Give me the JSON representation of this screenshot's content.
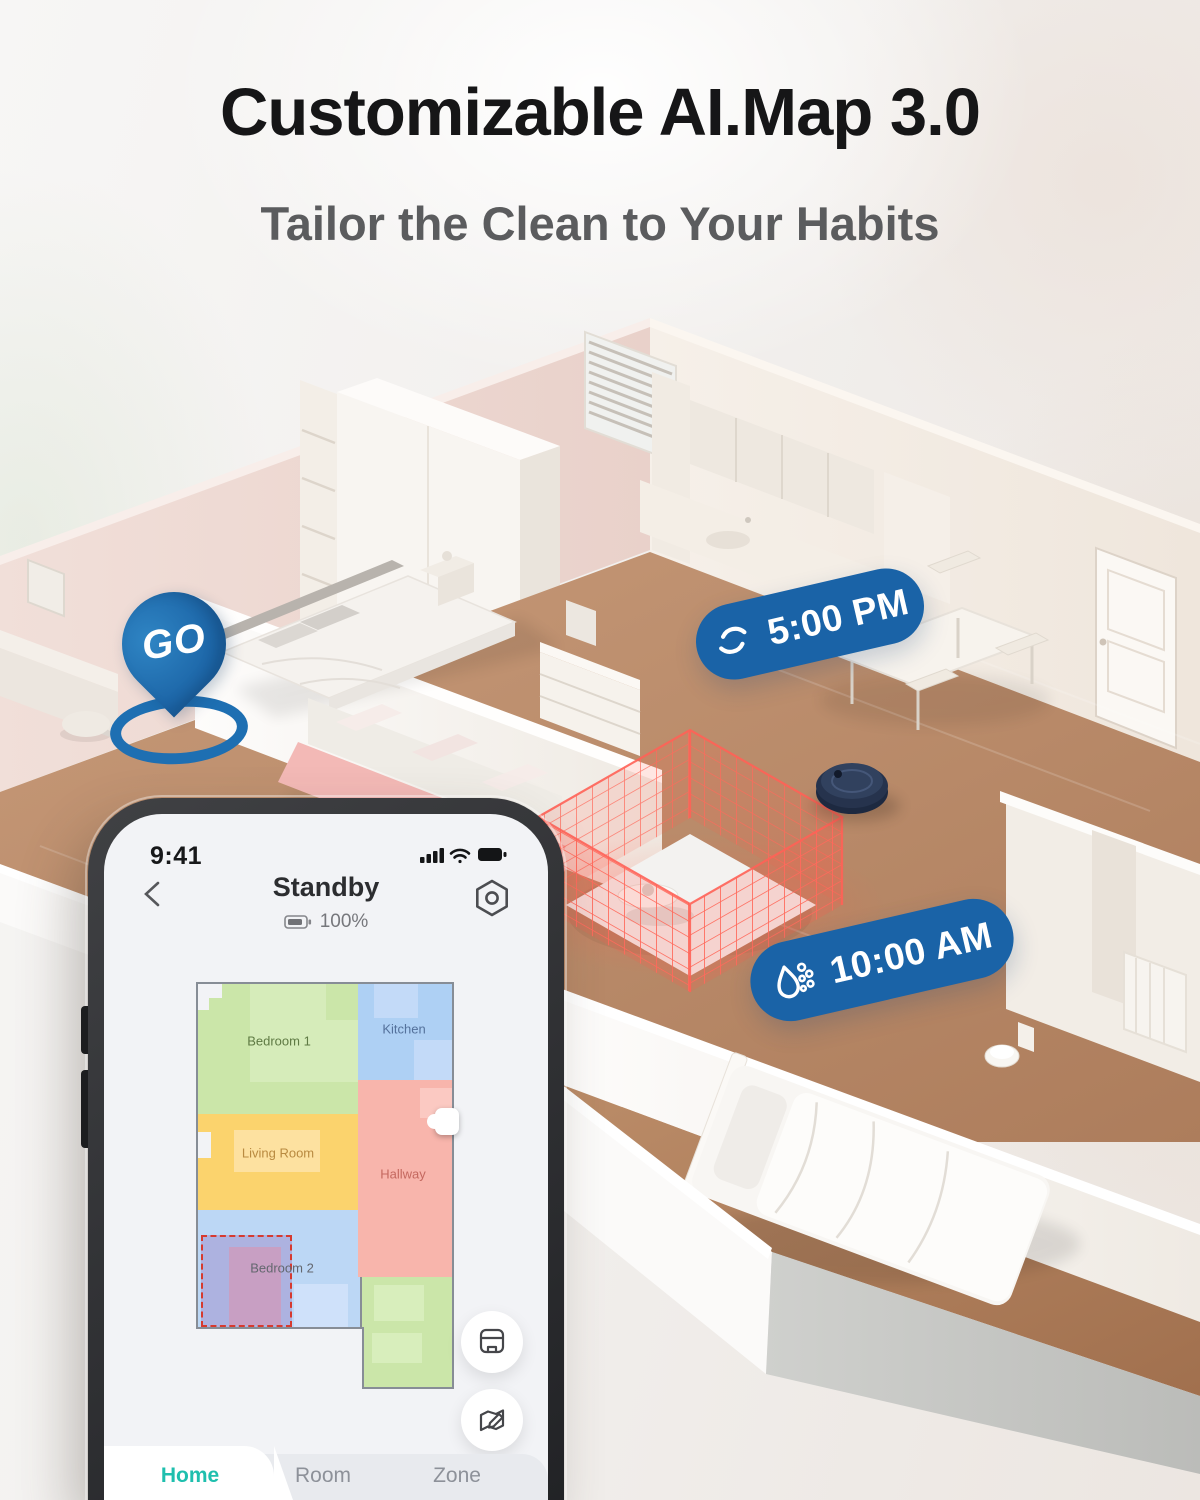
{
  "title": "Customizable AI.Map 3.0",
  "subtitle": "Tailor the Clean to Your Habits",
  "scene": {
    "go_pin": {
      "label": "GO",
      "color": "#1e6fb2"
    },
    "vacuum_badge": {
      "time": "5:00 PM",
      "icon": "spin-vacuum-icon",
      "color": "#1a63a7"
    },
    "mop_badge": {
      "time": "10:00 AM",
      "icon": "water-drop-icon",
      "color": "#1a63a7"
    },
    "no_go_zone_color": "#ff6257"
  },
  "phone": {
    "status_bar": {
      "time": "9:41",
      "icons": [
        "signal-icon",
        "wifi-icon",
        "battery-icon"
      ]
    },
    "header": {
      "title": "Standby",
      "battery_level": "100%",
      "left_icon": "back-chevron-icon",
      "right_icon": "settings-icon"
    },
    "map": {
      "rooms": [
        {
          "label": "Bedroom 1",
          "color": "#cbe6a9",
          "label_color": "#5f7a44"
        },
        {
          "label": "Kitchen",
          "color": "#aed0f4",
          "label_color": "#54719b"
        },
        {
          "label": "Living Room",
          "color": "#fbd36d",
          "label_color": "#b98a40"
        },
        {
          "label": "Hallway",
          "color": "#f8b5ac",
          "label_color": "#c4685f"
        },
        {
          "label": "Bedroom 2",
          "color": "#bcd7f5",
          "label_color": "#63676f"
        },
        {
          "label": "Bathroom",
          "color": "#cbe6a9",
          "label_color": "#567a3e"
        }
      ],
      "selection": {
        "room": "Bedroom 2",
        "border_color": "#d63a2f"
      },
      "buttons": [
        "save-map-button",
        "edit-map-button"
      ]
    },
    "tabs": [
      {
        "label": "Home",
        "active": true
      },
      {
        "label": "Room",
        "active": false
      },
      {
        "label": "Zone",
        "active": false
      }
    ],
    "accent": "#1fbfae"
  }
}
